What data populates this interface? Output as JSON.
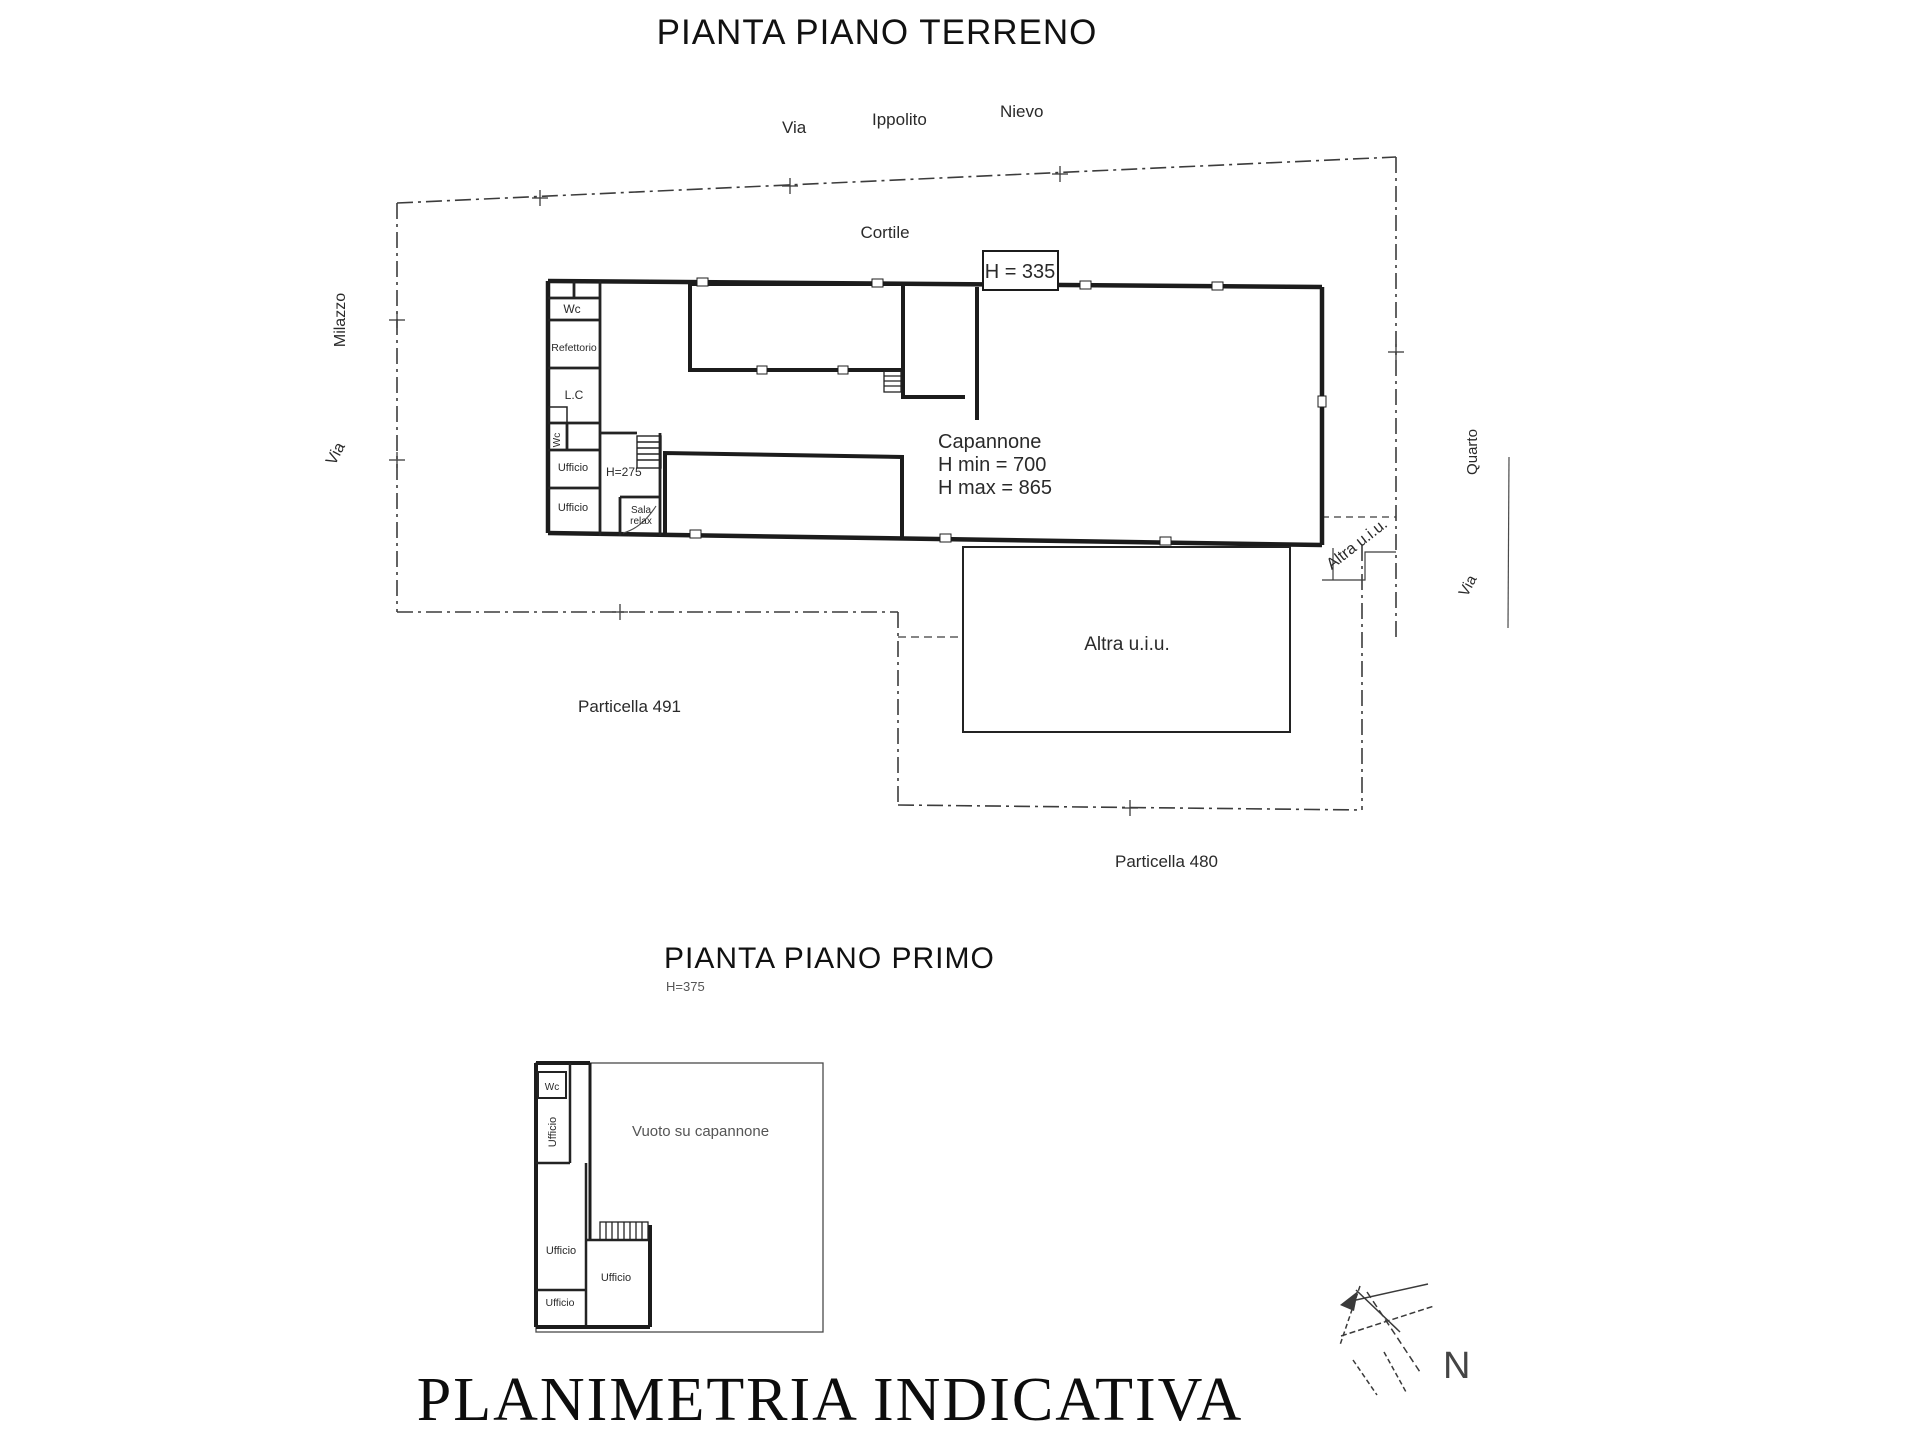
{
  "document": {
    "ground_title": "PIANTA PIANO TERRENO",
    "first_title": "PIANTA PIANO PRIMO",
    "first_height": "H=375",
    "footer": "PLANIMETRIA INDICATIVA",
    "north": "N",
    "ink_color": "#1c1c1c",
    "paper_color": "#ffffff"
  },
  "streets": {
    "top": {
      "via": "Via",
      "ippolito": "Ippolito",
      "nievo": "Nievo"
    },
    "left": {
      "via": "Via",
      "name": "Milazzo"
    },
    "right": {
      "via": "Via",
      "name": "Quarto"
    }
  },
  "ground": {
    "cortile": "Cortile",
    "height_box": "H = 335",
    "wc_top": "Wc",
    "refettorio": "Refettorio",
    "lc": "L.C",
    "wc_mid": "Wc",
    "ufficio_1": "Ufficio",
    "h275": "H=275",
    "ufficio_2": "Ufficio",
    "sala_line1": "Sala",
    "sala_line2": "relax",
    "capannone": "Capannone",
    "h_min": "H min = 700",
    "h_max": "H max = 865",
    "altra_large": "Altra u.i.u.",
    "altra_small": "Altra u.i.u.",
    "particella_left": "Particella 491",
    "particella_right": "Particella 480"
  },
  "first": {
    "wc": "Wc",
    "ufficio_top": "Ufficio",
    "vuoto": "Vuoto su capannone",
    "ufficio_left": "Ufficio",
    "ufficio_right": "Ufficio",
    "ufficio_bottom": "Ufficio"
  }
}
